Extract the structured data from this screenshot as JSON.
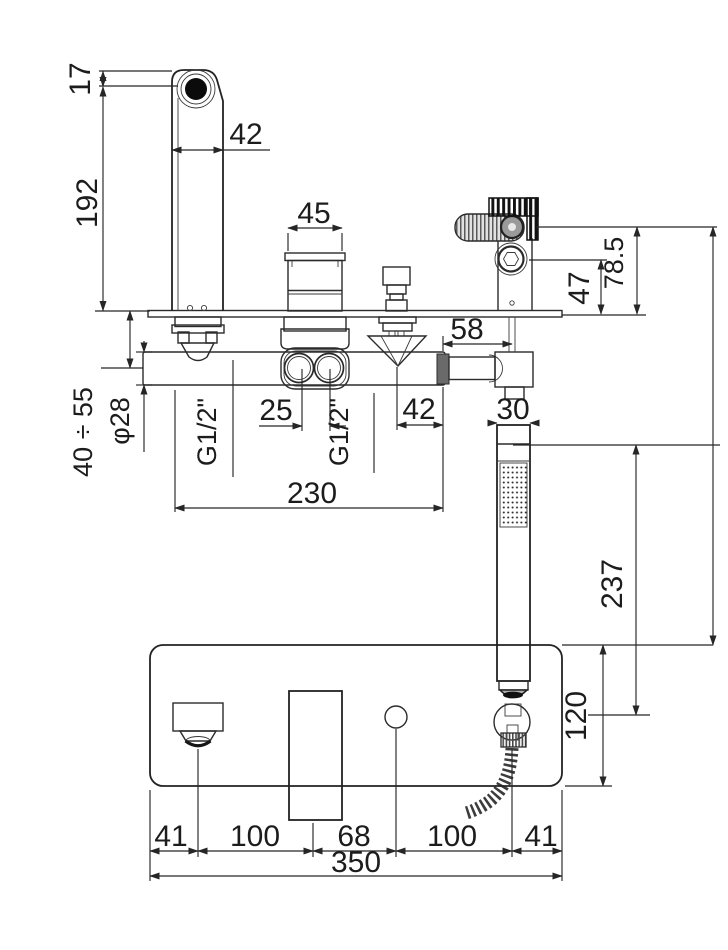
{
  "side_view": {
    "spout": {
      "tip_to_axis": "17",
      "height": "192",
      "width": "42"
    },
    "cartridge_width": "45",
    "diverter_offset": "42",
    "inlets": {
      "spacing": "25",
      "left_thread": "G1/2\"",
      "right_thread": "G1/2\""
    },
    "body": {
      "length": "230",
      "diameter": "φ28",
      "deck_thickness_range": "40 ÷ 55"
    },
    "holder": {
      "offset": "58",
      "socket_height": "47",
      "handle_height": "78.5"
    },
    "handshower": {
      "width": "30",
      "length": "237"
    }
  },
  "plan_view": {
    "plate_depth": "120",
    "plate_width": "350",
    "spacing_chain": [
      "41",
      "100",
      "68",
      "100",
      "41"
    ]
  }
}
